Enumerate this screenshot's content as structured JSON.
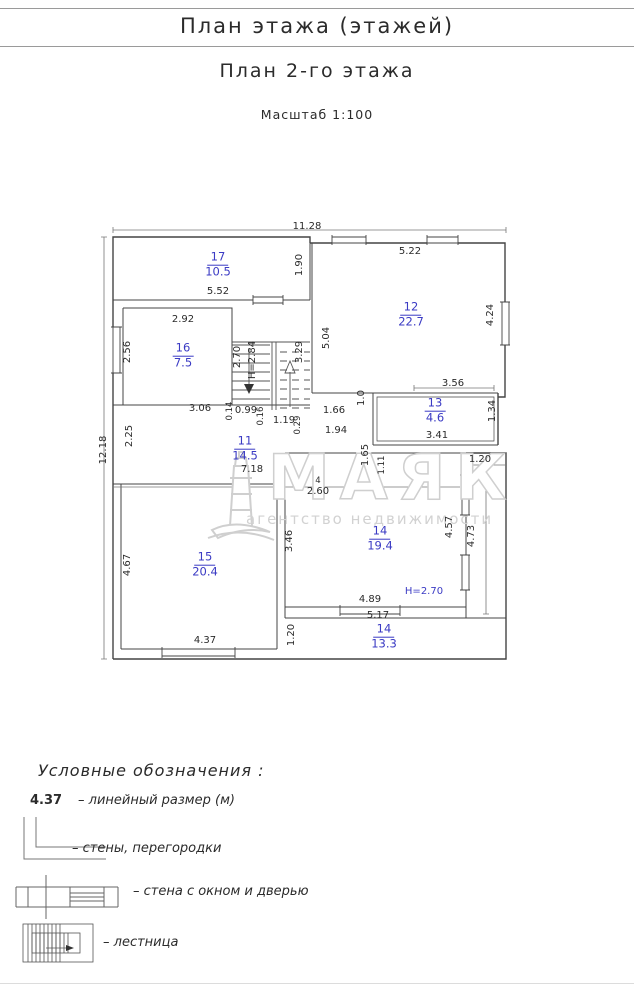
{
  "header": {
    "title": "План этажа (этажей)",
    "subtitle": "План 2-го этажа",
    "scale": "Масштаб 1:100"
  },
  "watermark": {
    "name": "МАЯК",
    "tagline": "агентство недвижимости"
  },
  "plan": {
    "overall_width_dim": "11.28",
    "overall_height_dim": "12.18",
    "rooms": [
      {
        "num": "17",
        "area": "10.5",
        "x": 120,
        "y": 43
      },
      {
        "num": "12",
        "area": "22.7",
        "x": 313,
        "y": 93
      },
      {
        "num": "16",
        "area": "7.5",
        "x": 85,
        "y": 134
      },
      {
        "num": "13",
        "area": "4.6",
        "x": 337,
        "y": 189
      },
      {
        "num": "11",
        "area": "14.5",
        "x": 147,
        "y": 227
      },
      {
        "num": "15",
        "area": "20.4",
        "x": 107,
        "y": 343
      },
      {
        "num": "14",
        "area": "19.4",
        "x": 282,
        "y": 317
      },
      {
        "num": "14",
        "area": "13.3",
        "x": 286,
        "y": 415
      }
    ],
    "dims": [
      {
        "t": "11.28",
        "x": 209,
        "y": 5
      },
      {
        "t": "5.52",
        "x": 120,
        "y": 70
      },
      {
        "t": "2.92",
        "x": 85,
        "y": 98
      },
      {
        "t": "5.22",
        "x": 312,
        "y": 30
      },
      {
        "t": "3.06",
        "x": 102,
        "y": 187
      },
      {
        "t": "0.99",
        "x": 148,
        "y": 189
      },
      {
        "t": "1.19",
        "x": 186,
        "y": 199
      },
      {
        "t": "1.66",
        "x": 236,
        "y": 189
      },
      {
        "t": "1.94",
        "x": 238,
        "y": 209
      },
      {
        "t": "3.56",
        "x": 355,
        "y": 162
      },
      {
        "t": "3.41",
        "x": 339,
        "y": 214
      },
      {
        "t": "7.18",
        "x": 154,
        "y": 248
      },
      {
        "t": "4",
        "x": 220,
        "y": 259,
        "small": true
      },
      {
        "t": "2.60",
        "x": 220,
        "y": 270
      },
      {
        "t": "4.37",
        "x": 107,
        "y": 419
      },
      {
        "t": "4.89",
        "x": 272,
        "y": 378
      },
      {
        "t": "5.17",
        "x": 280,
        "y": 394
      },
      {
        "t": "1.20",
        "x": 382,
        "y": 238
      },
      {
        "t": "12.18",
        "x": 6,
        "y": 228,
        "rot": true
      },
      {
        "t": "1.90",
        "x": 202,
        "y": 43,
        "rot": true
      },
      {
        "t": "5.04",
        "x": 229,
        "y": 116,
        "rot": true
      },
      {
        "t": "4.24",
        "x": 393,
        "y": 93,
        "rot": true
      },
      {
        "t": "2.56",
        "x": 30,
        "y": 130,
        "rot": true
      },
      {
        "t": "2.70",
        "x": 140,
        "y": 135,
        "rot": true
      },
      {
        "t": "H=2.84",
        "x": 155,
        "y": 138,
        "rot": true
      },
      {
        "t": "3.29",
        "x": 202,
        "y": 130,
        "rot": true
      },
      {
        "t": "0.14",
        "x": 132,
        "y": 189,
        "rot": true,
        "small": true
      },
      {
        "t": "0.16",
        "x": 163,
        "y": 194,
        "rot": true,
        "small": true
      },
      {
        "t": "0.29",
        "x": 200,
        "y": 203,
        "rot": true,
        "small": true
      },
      {
        "t": "2.25",
        "x": 32,
        "y": 214,
        "rot": true
      },
      {
        "t": "1.0",
        "x": 264,
        "y": 176,
        "rot": true
      },
      {
        "t": "1.34",
        "x": 395,
        "y": 189,
        "rot": true
      },
      {
        "t": "1.65",
        "x": 268,
        "y": 233,
        "rot": true
      },
      {
        "t": "1.11",
        "x": 284,
        "y": 243,
        "rot": true,
        "small": true
      },
      {
        "t": "3.46",
        "x": 192,
        "y": 319,
        "rot": true
      },
      {
        "t": "4.67",
        "x": 30,
        "y": 343,
        "rot": true
      },
      {
        "t": "4.57",
        "x": 352,
        "y": 305,
        "rot": true
      },
      {
        "t": "4.73",
        "x": 374,
        "y": 314,
        "rot": true
      },
      {
        "t": "1.20",
        "x": 194,
        "y": 413,
        "rot": true
      },
      {
        "t": "H=2.70",
        "x": 326,
        "y": 370,
        "blue": true
      }
    ]
  },
  "legend": {
    "title": "Условные обозначения :",
    "dim_example": "4.37",
    "items": [
      {
        "label": "– линейный размер (м)"
      },
      {
        "label": "– стены, перегородки"
      },
      {
        "label": "– стена с окном и дверью"
      },
      {
        "label": "– лестница"
      }
    ]
  },
  "colors": {
    "accent_blue": "#3b3bc4",
    "line": "#444444",
    "watermark_gray": "#d0d0d0"
  }
}
